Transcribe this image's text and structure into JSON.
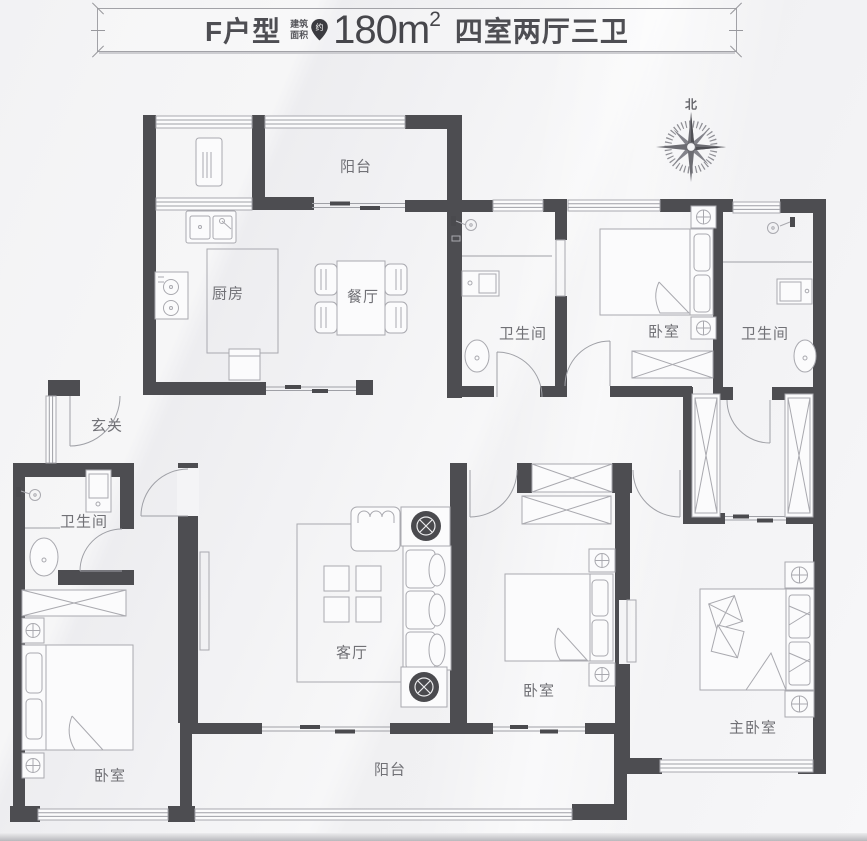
{
  "header": {
    "unit": "F户型",
    "area_note_l1": "建筑",
    "area_note_l2": "面积",
    "approx": "约",
    "area": "180m",
    "area_exp": "2",
    "rooms_summary": "四室两厅三卫"
  },
  "compass": {
    "north": "北"
  },
  "room_labels": {
    "balcony_top": "阳台",
    "kitchen": "厨房",
    "dining": "餐厅",
    "bathroom_center": "卫生间",
    "bedroom_top_right": "卧室",
    "bathroom_right": "卫生间",
    "entry": "玄关",
    "bathroom_left": "卫生间",
    "living": "客厅",
    "bedroom_bottom_center": "卧室",
    "bedroom_bottom_left": "卧室",
    "master_bedroom": "主卧室",
    "balcony_bottom": "阳台"
  },
  "colors": {
    "wall": "#4d4d51",
    "thin_line": "#9fa0a6",
    "background": "#f4f4f6",
    "text": "#717176",
    "header_text": "#4e4e53"
  }
}
